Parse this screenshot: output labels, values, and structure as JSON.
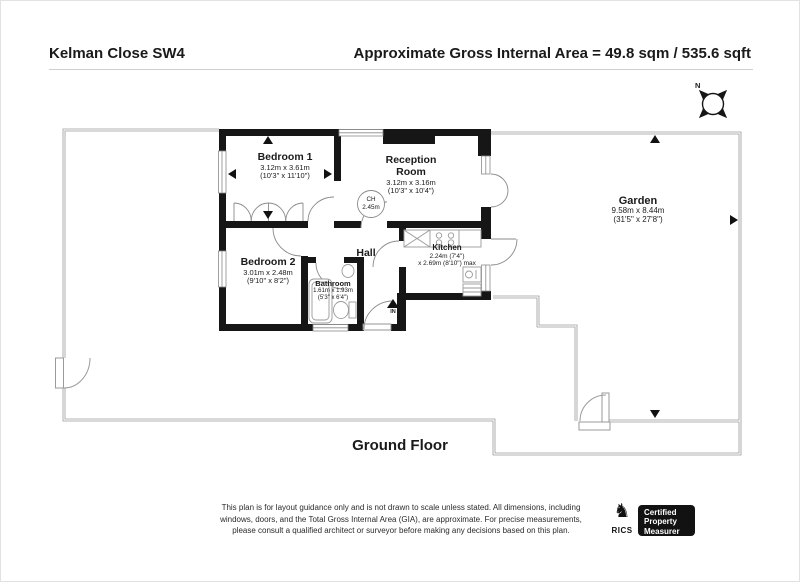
{
  "header": {
    "title": "Kelman Close SW4",
    "area": "Approximate Gross Internal Area = 49.8 sqm / 535.6 sqft"
  },
  "compass": {
    "north_label": "N"
  },
  "rooms": {
    "bedroom1": {
      "name": "Bedroom 1",
      "dims_m": "3.12m x 3.61m",
      "dims_ft": "(10'3\" x 11'10\")"
    },
    "reception": {
      "name_line1": "Reception",
      "name_line2": "Room",
      "dims_m": "3.12m x 3.16m",
      "dims_ft": "(10'3\" x 10'4\")"
    },
    "bedroom2": {
      "name": "Bedroom 2",
      "dims_m": "3.01m x 2.48m",
      "dims_ft": "(9'10\" x 8'2\")"
    },
    "hall": {
      "name": "Hall"
    },
    "kitchen": {
      "name": "Kitchen",
      "dims_m_line1": "2.24m (7'4\")",
      "dims_m_line2": "x 2.69m (8'10\") max"
    },
    "bathroom": {
      "name": "Bathroom",
      "dims_m": "1.61m x 1.93m",
      "dims_ft": "(5'3\" x 6'4\")"
    },
    "garden": {
      "name": "Garden",
      "dims_m": "9.58m x 8.44m",
      "dims_ft": "(31'5\" x 27'8\")"
    }
  },
  "ceiling_height": {
    "line1": "CH",
    "line2": "2.45m"
  },
  "entrance": {
    "label": "IN"
  },
  "floor_label": "Ground Floor",
  "footer": {
    "disclaimer_line1": "This plan is for layout guidance only and is not drawn to scale unless stated. All dimensions, including",
    "disclaimer_line2": "windows, doors, and the Total Gross Internal Area (GIA), are approximate. For precise measurements,",
    "disclaimer_line3": "please consult a qualified architect or surveyor before making any decisions based on this plan.",
    "rics": {
      "brand": "RICS",
      "badge_line1": "Certified",
      "badge_line2": "Property",
      "badge_line3": "Measurer"
    }
  },
  "colors": {
    "wall": "#161616",
    "boundary": "#9a9a9a",
    "fixture": "#8f8f8f"
  }
}
